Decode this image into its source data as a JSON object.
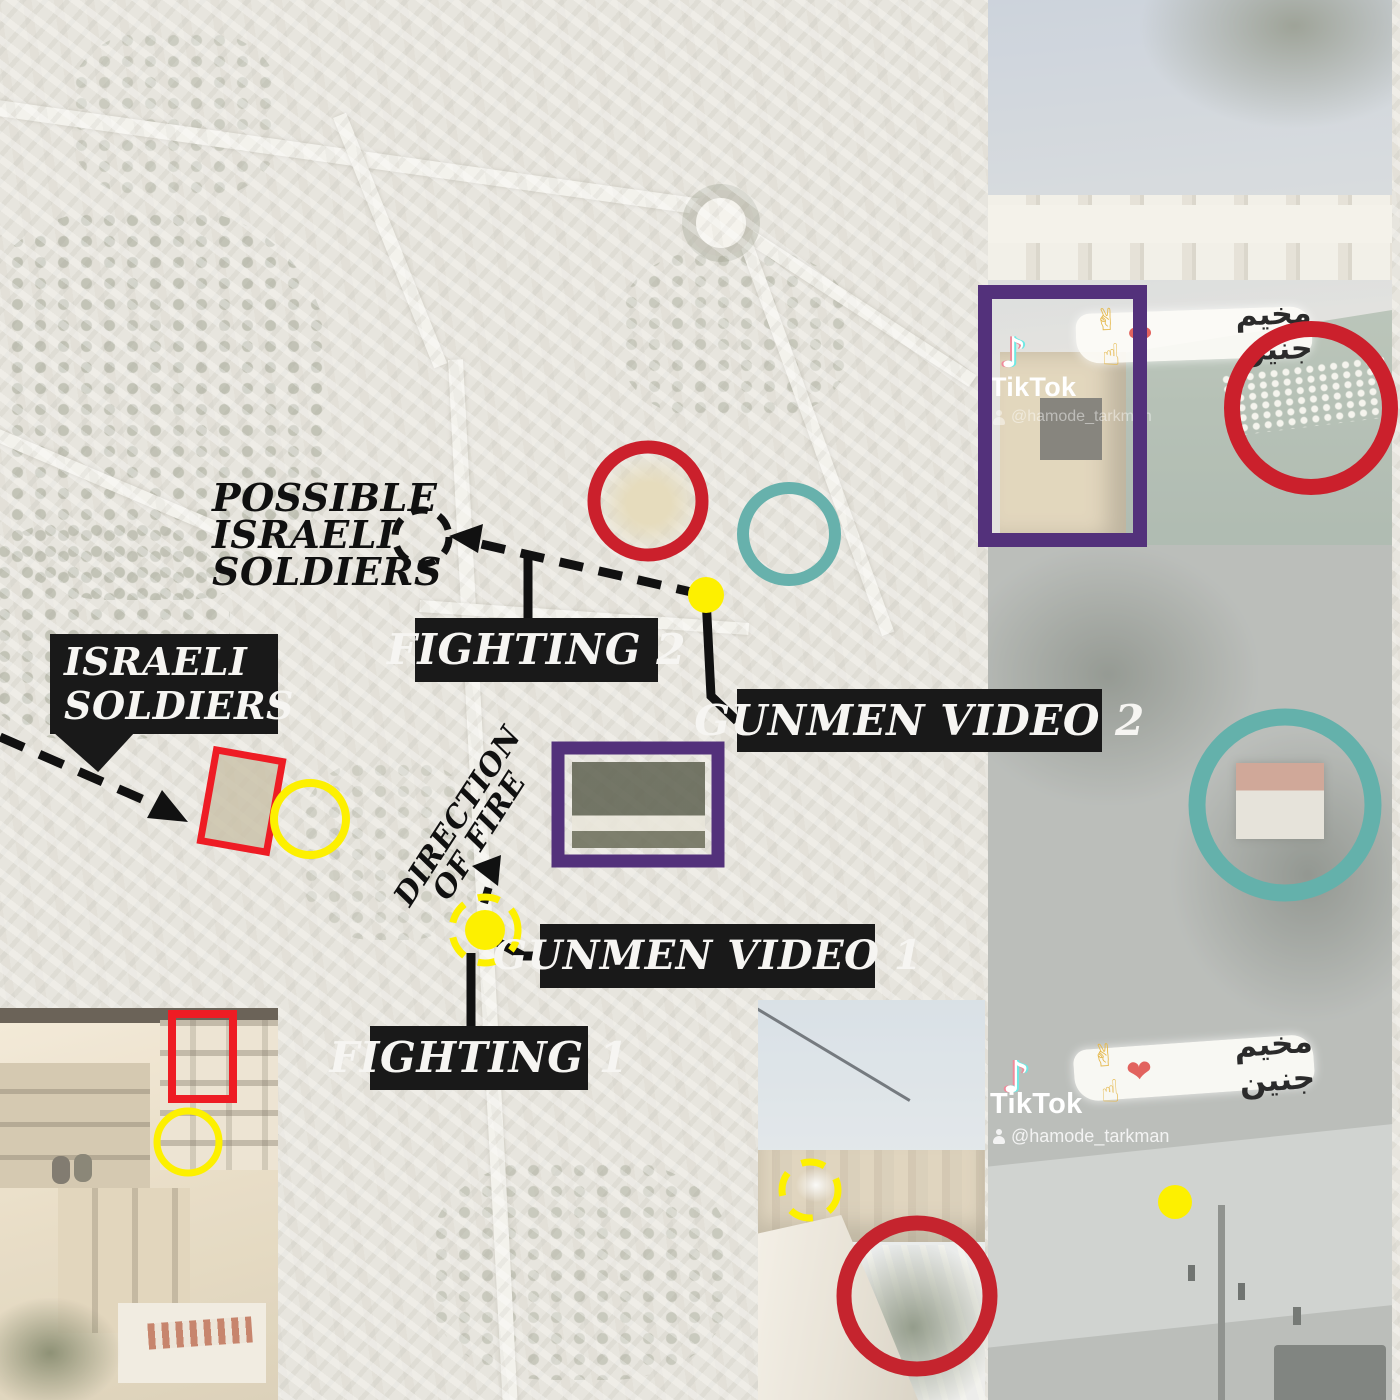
{
  "graphic": {
    "type": "annotated satellite investigation graphic",
    "location_hint": "Jenin camp (from video caption)"
  },
  "map_labels": {
    "possible_israeli_soldiers": {
      "lines": [
        "POSSIBLE",
        "ISRAELI",
        "SOLDIERS"
      ]
    },
    "israeli_soldiers": {
      "lines": [
        "ISRAELI",
        "SOLDIERS"
      ]
    },
    "fighting_1": "FIGHTING 1",
    "fighting_2": "FIGHTING 2",
    "gunmen_video_1": "GUNMEN VIDEO 1",
    "gunmen_video_2": "GUNMEN VIDEO 2",
    "direction_of_fire": {
      "lines": [
        "DIRECTION",
        "OF FIRE"
      ]
    }
  },
  "tiktok": {
    "brand": "TikTok",
    "note_icon": "♪",
    "username": "@hamode_tarkman",
    "caption_arabic": "مخيم جنين",
    "caption_heart": "❤",
    "caption_gestures": "✌☝"
  },
  "colors": {
    "annotation_red": "#cb202c",
    "box_red": "#ee1c24",
    "annotation_yellow": "#fdf000",
    "annotation_teal": "#67b1ac",
    "annotation_purple": "#53317b",
    "label_background": "#191919",
    "label_text": "#f6f5f2"
  }
}
